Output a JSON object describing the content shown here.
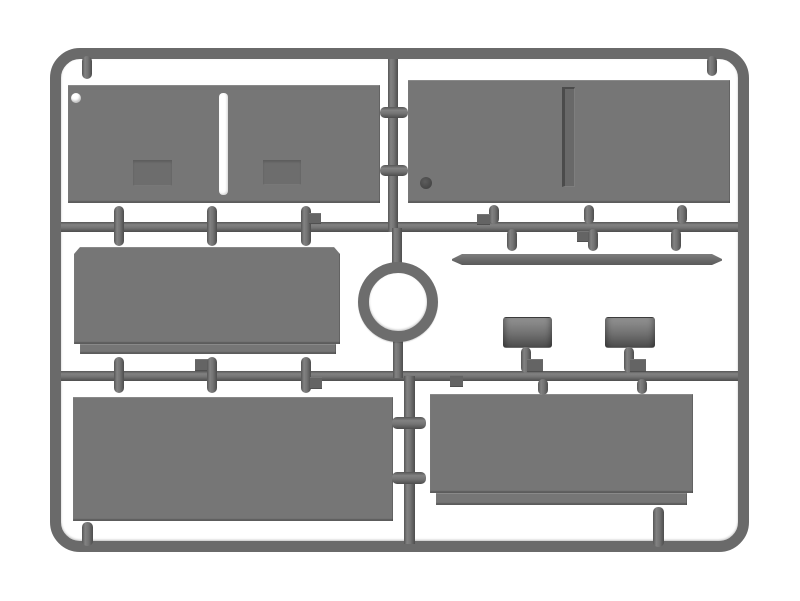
{
  "scene": {
    "type": "model-kit-sprue-render",
    "description": "Gray injection-molded plastic sprue frame holding flat body panels, a circular ring, a long rod and two small cylinders, on a white background",
    "orientation": "landscape"
  },
  "colors": {
    "background": "#ffffff",
    "plastic": "#767676",
    "frame": "#6a6a6a",
    "recess": "#6d6d6d",
    "hole_light": "#ffffff",
    "hole_dark": "#474747"
  },
  "parts": [
    {
      "name": "panel-top-left",
      "features": [
        "round hole top-left",
        "white vertical slot center",
        "two recessed hatches"
      ]
    },
    {
      "name": "panel-top-right",
      "features": [
        "recessed vertical groove center",
        "dark round recess bottom-left"
      ]
    },
    {
      "name": "panel-middle-left",
      "features": [
        "chamfered top corners",
        "stepped bottom strip"
      ]
    },
    {
      "name": "ring",
      "features": [
        "circular ring part at sprue center"
      ]
    },
    {
      "name": "rod",
      "features": [
        "long thin bar with beveled ends"
      ]
    },
    {
      "name": "cylinder-left",
      "features": [
        "small drum-shaped part"
      ]
    },
    {
      "name": "cylinder-right",
      "features": [
        "small drum-shaped part"
      ]
    },
    {
      "name": "panel-bottom-left",
      "features": [
        "plain rectangle"
      ]
    },
    {
      "name": "panel-bottom-right",
      "features": [
        "stepped bottom strip"
      ]
    }
  ],
  "runner_layout": {
    "horizontal_runners": 2,
    "vertical_center_runner": true,
    "gate_stub_count_approx": 24
  }
}
